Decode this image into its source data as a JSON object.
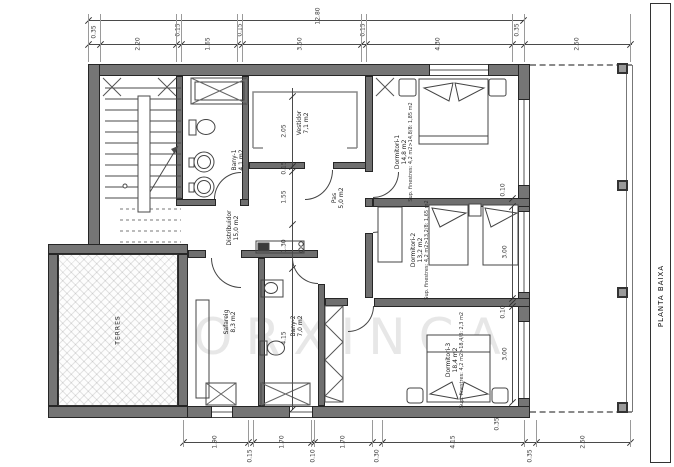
{
  "title_block": {
    "label": "PLANTA BAIXA"
  },
  "watermark": "PORXINCA",
  "rooms": {
    "bany1": {
      "name": "Bany-1",
      "area": "4,1 m2"
    },
    "vestidor": {
      "name": "Vestidor",
      "area": "7,1 m2"
    },
    "pas": {
      "name": "Pas",
      "area": "5,0 m2"
    },
    "dormitori1": {
      "name": "Dormitori-1",
      "area": "14,8 m2",
      "windows": "Sup. finestres: 4,2 m2>14,8/8: 1,85 m2"
    },
    "distribuidor": {
      "name": "Distribuidor",
      "area": "15,0 m2"
    },
    "dormitori2": {
      "name": "Dormitori-2",
      "area": "13,2 m2",
      "windows": "Sup. finestres: 4,2 m2>13,2/8: 1,65 m2"
    },
    "safareig": {
      "name": "Safareig",
      "area": "8,3 m2"
    },
    "bany2": {
      "name": "Bany-2",
      "area": "7,0 m2"
    },
    "dormitori3": {
      "name": "Dormitori-3",
      "area": "18,4 m2",
      "windows": "Sup. finestres: 4,2 m2>18,4/8: 2,3 m2"
    },
    "terres": {
      "name": "TERRES"
    }
  },
  "dimensions": {
    "top_total": "12.80",
    "top": [
      "0.35",
      "2.20",
      "0.15",
      "1.65",
      "0.15",
      "3.50",
      "0.15",
      "4.30",
      "0.35",
      "2.50"
    ],
    "bottom": [
      "1.90",
      "0.15",
      "1.70",
      "0.10",
      "1.70",
      "0.30",
      "4.15",
      "0.35",
      "2.50"
    ],
    "vertical_chain": [
      "2.05",
      "0.15",
      "1.55",
      "1.30",
      "4.15"
    ],
    "dorm2_depth": "3.00",
    "dorm3_depth": "3.00",
    "small": [
      "0.10",
      "0.10",
      "0.35"
    ]
  }
}
